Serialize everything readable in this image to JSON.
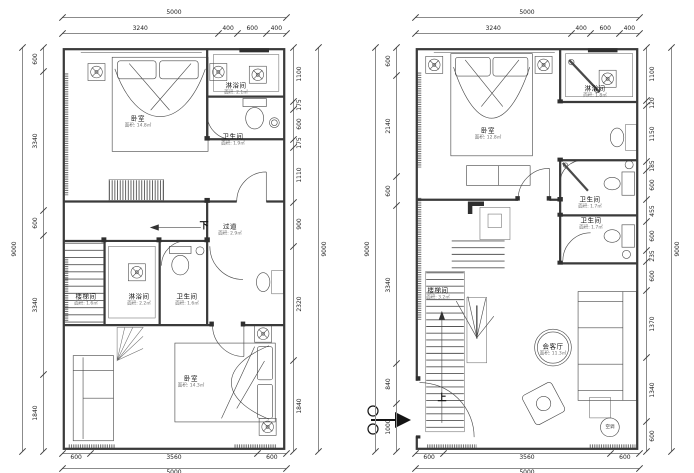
{
  "plans": [
    {
      "name": "upper-floor-plan",
      "dims": {
        "top_overall": [
          "5000"
        ],
        "top_segments": [
          "3240",
          "400",
          "600",
          "400"
        ],
        "left_overall": [
          "9000"
        ],
        "left_segments": [
          "600",
          "3340",
          "600",
          "3340",
          "1840"
        ],
        "right_overall": [
          "9000"
        ],
        "right_segments": [
          "1100",
          "175",
          "600",
          "175",
          "1110",
          "900",
          "2320",
          "1840"
        ],
        "bottom_segments": [
          "600",
          "3560",
          "600"
        ],
        "bottom_overall": [
          "5000"
        ]
      },
      "rooms": {
        "bedroom_top": {
          "name": "卧室",
          "area": "面积: 14.8㎡"
        },
        "shower_top": {
          "name": "淋浴间",
          "area": "面积: 2.1㎡"
        },
        "bath_top": {
          "name": "卫生间",
          "area": "面积: 1.9㎡"
        },
        "corridor": {
          "name": "过道",
          "area": "面积: 2.9㎡",
          "direction": "下"
        },
        "stair_room": {
          "name": "楼梯间",
          "area": "面积: 1.6㎡"
        },
        "shower_mid": {
          "name": "淋浴间",
          "area": "面积: 2.2㎡"
        },
        "bath_mid": {
          "name": "卫生间",
          "area": "面积: 1.6㎡"
        },
        "bedroom_bottom": {
          "name": "卧室",
          "area": "面积: 14.3㎡"
        }
      }
    },
    {
      "name": "ground-floor-plan",
      "dims": {
        "top_overall": [
          "5000"
        ],
        "top_segments": [
          "3240",
          "400",
          "600",
          "400"
        ],
        "left_overall": [
          "9000"
        ],
        "left_segments": [
          "600",
          "2140",
          "600",
          "3340",
          "840",
          "1000"
        ],
        "right_overall": [
          "9000"
        ],
        "right_segments": [
          "1100",
          "120",
          "1150",
          "185",
          "600",
          "455",
          "600",
          "235",
          "600",
          "1370",
          "1340",
          "600"
        ],
        "bottom_segments": [
          "600",
          "3560",
          "600"
        ],
        "bottom_overall": [
          "5000"
        ]
      },
      "rooms": {
        "bedroom": {
          "name": "卧室",
          "area": "面积: 12.8㎡"
        },
        "shower": {
          "name": "淋浴间",
          "area": "面积: 1.8㎡"
        },
        "bath_1": {
          "name": "卫生间",
          "area": "面积: 1.7㎡"
        },
        "bath_2": {
          "name": "卫生间",
          "area": "面积: 1.7㎡"
        },
        "stair_room": {
          "name": "楼梯间",
          "area": "面积: 3.2㎡"
        },
        "living": {
          "name": "会客厅",
          "area": "面积: 11.3㎡",
          "direction": "上"
        },
        "ac": {
          "name": "空调"
        }
      }
    }
  ]
}
